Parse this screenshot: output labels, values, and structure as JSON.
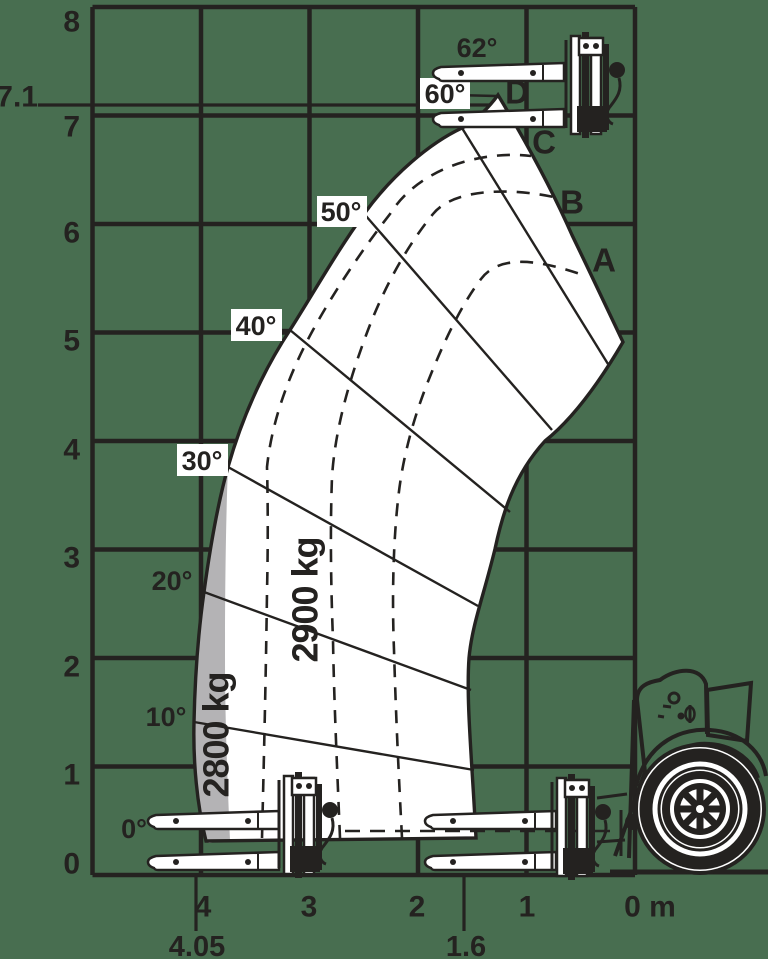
{
  "colors": {
    "background": "#486e50",
    "ink": "#242220",
    "envelope_fill": "#ffffff",
    "zone_2800_fill": "#b4b3b5"
  },
  "axes": {
    "y": [
      "8",
      "7.1",
      "7",
      "6",
      "5",
      "4",
      "3",
      "2",
      "1",
      "0"
    ],
    "x": [
      "4",
      "3",
      "2",
      "1",
      "0 m"
    ],
    "x_extra": [
      "4.05",
      "1.6"
    ]
  },
  "angles": [
    "0°",
    "10°",
    "20°",
    "30°",
    "40°",
    "50°",
    "60°",
    "62°"
  ],
  "zones": {
    "outer": "2800 kg",
    "main": "2900 kg"
  },
  "marks": [
    "A",
    "B",
    "C",
    "D"
  ],
  "chart_data": {
    "type": "area",
    "description": "Telehandler load capacity envelope: lift height (m) vs forward reach (m) with boom angle lines, telescope extension arcs A-D and capacity zones",
    "x_axis": {
      "unit": "m",
      "direction": "right-to-left",
      "ticks": [
        4,
        3,
        2,
        1,
        0
      ],
      "extra_ticks": [
        4.05,
        1.6
      ],
      "range": [
        0,
        5
      ]
    },
    "y_axis": {
      "unit": "m",
      "ticks": [
        0,
        1,
        2,
        3,
        4,
        5,
        6,
        7,
        8
      ],
      "extra_ticks": [
        7.1
      ],
      "range": [
        0,
        8
      ]
    },
    "grid": true,
    "boom_angles_deg": [
      0,
      10,
      20,
      30,
      40,
      50,
      60,
      62
    ],
    "extension_marks": [
      "A",
      "B",
      "C",
      "D"
    ],
    "max_lift_height_m": 7.1,
    "max_reach_m": 4.05,
    "retracted_reach_m": 1.6,
    "capacity_zones": [
      {
        "label": "2900 kg",
        "capacity_kg": 2900,
        "region": "main envelope area"
      },
      {
        "label": "2800 kg",
        "capacity_kg": 2800,
        "region": "outer strip near maximum reach, below 30 deg"
      }
    ],
    "envelope_outer_boundary_m": [
      [
        4.07,
        0.31
      ],
      [
        4.08,
        1.41
      ],
      [
        3.97,
        2.61
      ],
      [
        3.75,
        3.76
      ],
      [
        3.18,
        5.02
      ],
      [
        2.5,
        6.09
      ],
      [
        1.6,
        6.9
      ],
      [
        1.26,
        7.19
      ]
    ],
    "envelope_inner_boundary_m": [
      [
        1.26,
        7.19
      ],
      [
        0.69,
        5.95
      ],
      [
        0.11,
        4.91
      ],
      [
        0.83,
        4.0
      ],
      [
        1.29,
        3.0
      ],
      [
        1.54,
        2.0
      ],
      [
        1.49,
        1.11
      ],
      [
        1.45,
        0.34
      ]
    ]
  }
}
